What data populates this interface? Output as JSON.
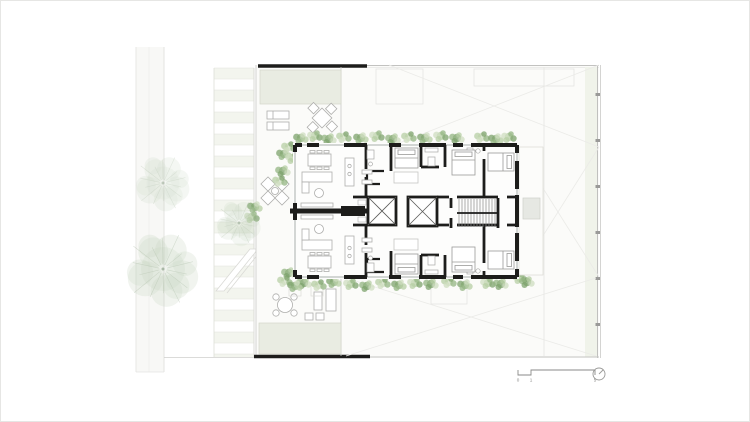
{
  "drawing_title": "ground-floor-site-plan",
  "colors": {
    "background": "#ffffff",
    "wall_black": "#1d1d1b",
    "line_light": "#c9c9c7",
    "line_faint": "#e9e8e5",
    "paving": "#f8f8f6",
    "sage_fill": "#e9ece2",
    "stripe_fill": "#f3f5ee",
    "stripe_line": "#e2e4dc",
    "furniture_line": "#aeaeac",
    "annotation_gray": "#8a8a88",
    "hedge_greens": [
      "#94b583",
      "#b7cfa4",
      "#7da36c",
      "#cfdec0"
    ],
    "tree_fill": "#b9ccb2",
    "tree_branch": "#a3b59c"
  },
  "scale_bar": {
    "labels": {
      "zero": "0",
      "one": "1",
      "five": "5"
    }
  },
  "north_arrow": {
    "icon": "north-arrow-icon"
  },
  "vegetation": {
    "trees": [
      {
        "x": 162,
        "y": 182,
        "r": 33,
        "opacity": 0.55
      },
      {
        "x": 162,
        "y": 268,
        "r": 44,
        "opacity": 0.75
      },
      {
        "x": 238,
        "y": 222,
        "r": 27,
        "opacity": 0.6
      }
    ],
    "hedges": [
      [
        300,
        137
      ],
      [
        314,
        135
      ],
      [
        328,
        138
      ],
      [
        343,
        136
      ],
      [
        360,
        137
      ],
      [
        376,
        135
      ],
      [
        392,
        138
      ],
      [
        408,
        136
      ],
      [
        424,
        137
      ],
      [
        440,
        135
      ],
      [
        456,
        137
      ],
      [
        481,
        136
      ],
      [
        495,
        138
      ],
      [
        508,
        136
      ],
      [
        303,
        282
      ],
      [
        318,
        284
      ],
      [
        333,
        281
      ],
      [
        350,
        283
      ],
      [
        366,
        285
      ],
      [
        382,
        282
      ],
      [
        398,
        284
      ],
      [
        414,
        282
      ],
      [
        430,
        283
      ],
      [
        448,
        281
      ],
      [
        464,
        284
      ],
      [
        487,
        282
      ],
      [
        500,
        283
      ],
      [
        288,
        146
      ],
      [
        283,
        153
      ],
      [
        292,
        157
      ],
      [
        282,
        170
      ],
      [
        279,
        180
      ],
      [
        254,
        206
      ],
      [
        251,
        216
      ],
      [
        288,
        272
      ],
      [
        284,
        280
      ],
      [
        294,
        285
      ],
      [
        519,
        277
      ],
      [
        526,
        281
      ]
    ]
  },
  "sidewalk_stripes": {
    "x": 213,
    "width": 40,
    "y_start": 67,
    "y_end": 356,
    "step": 11
  },
  "fence_posts": {
    "x": 595.5,
    "ys": [
      92,
      138,
      184,
      230,
      276,
      322
    ]
  },
  "stairs": {
    "x_start": 458,
    "x_end": 494,
    "step": 3,
    "y_top": 198,
    "y_bottom": 226
  }
}
